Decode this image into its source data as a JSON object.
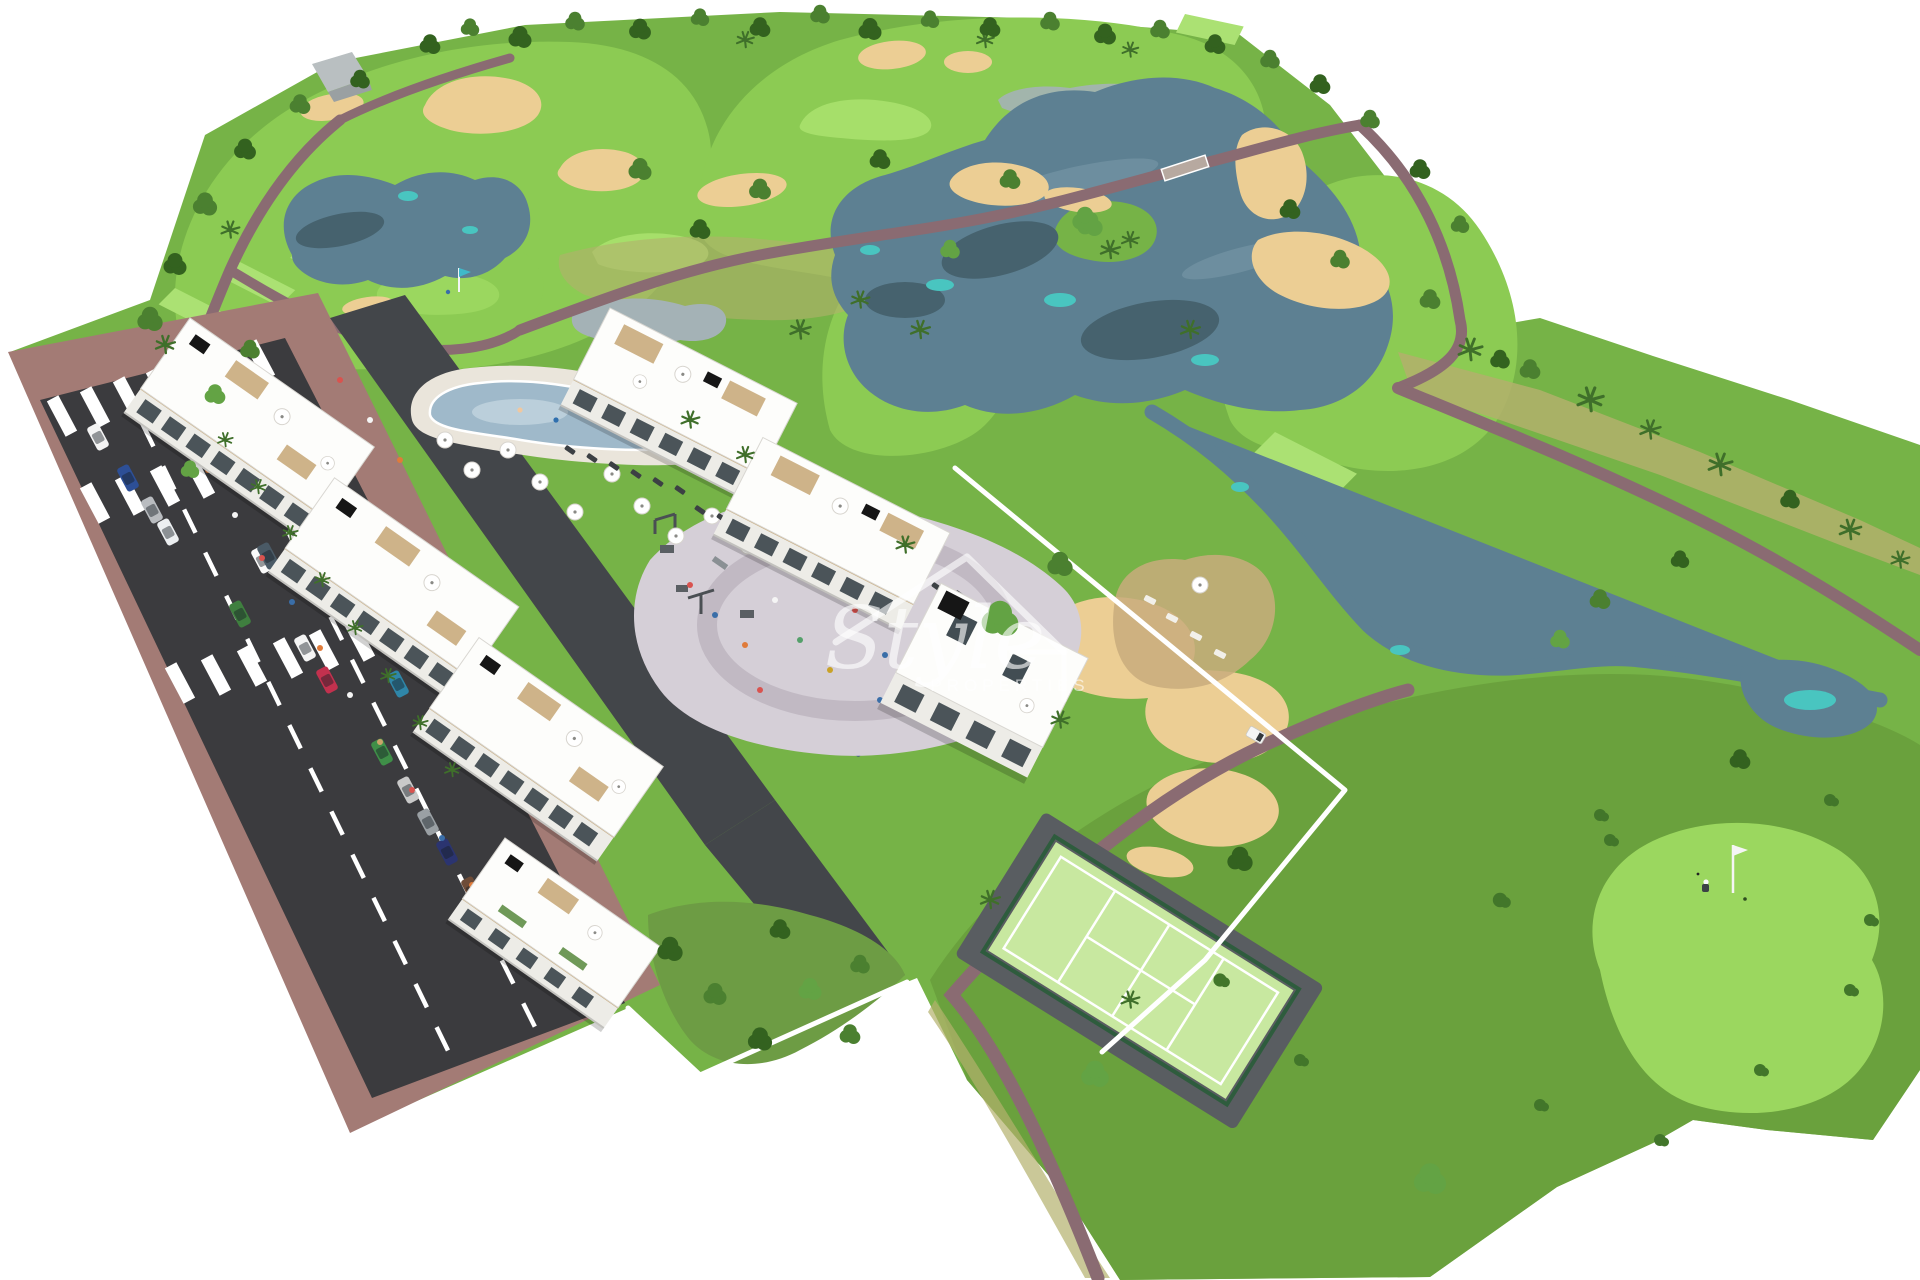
{
  "watermark": {
    "line1": "Style",
    "line2": "PROPERTIES"
  },
  "palette": {
    "bg": "#ffffff",
    "rough": "#76b347",
    "roughDark": "#699f3c",
    "fairway": "#8ccb53",
    "fairwayLight": "#a6df6a",
    "tee": "#abe173",
    "puttingGreen": "#9bd75f",
    "scrub": "#b3b06c",
    "sand": "#ecce94",
    "lake": "#5d8092",
    "lakeDeep": "#46626e",
    "lakeLight": "#7e9cab",
    "turquoise": "#49c5c0",
    "pond": "#a4b2b6",
    "path": "#8a6b72",
    "road": "#3b3b3e",
    "sidewalk": "#a37b75",
    "driveway": "#43464a",
    "wall": "#ffffff",
    "building": "#fdfdfb",
    "facade": "#edece7",
    "windowDark": "#2e3a40",
    "beige": "#c9ab7c",
    "rooftopBox": "#161616",
    "poolWater": "#9fb9ca",
    "poolDeck": "#eae5db",
    "courtGreen": "#c8e8a0",
    "courtFence": "#2e5c3d",
    "courtApron": "#595d61",
    "plaza": "#d5cfd7",
    "plazaRing": "#c1b9c3",
    "treeDark": "#33621f",
    "treeMid": "#4b8030",
    "treeLight": "#63a344",
    "palm": "#3f6f2a",
    "bush": "#42762a",
    "watermark": "rgba(255,255,255,0.62)"
  },
  "scene": {
    "features": [
      "golf-course",
      "lakes",
      "sand-bunkers",
      "winding-paths",
      "apartment-blocks",
      "swimming-pool",
      "sun-umbrellas",
      "paddle-tennis-court",
      "playground-plaza",
      "road-with-parked-cars",
      "crosswalks",
      "putting-green-with-flag",
      "golfer",
      "golf-cart",
      "palm-trees",
      "perimeter-walls"
    ],
    "car_colors_visible": [
      "white",
      "silver",
      "blue",
      "red",
      "teal",
      "green",
      "brown",
      "navy",
      "dark-gray"
    ],
    "golf_flags_visible": 2,
    "golfers_visible": 2,
    "golf_carts_visible": 1
  }
}
